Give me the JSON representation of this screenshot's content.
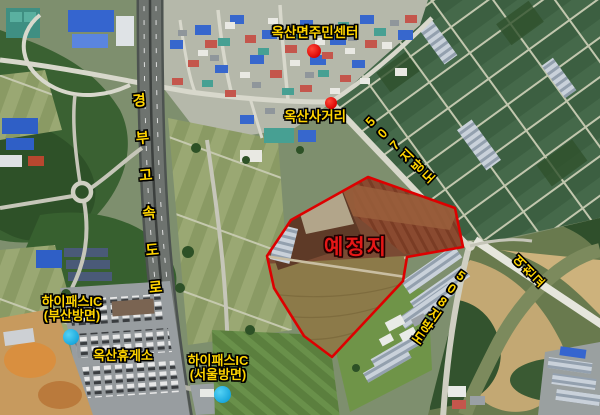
{
  "map": {
    "labels": {
      "community_center": "옥산면주민센터",
      "intersection": "옥산사거리",
      "road_507": "507지방도",
      "expressway": "경부고속도로",
      "hipass_busan": {
        "line1": "하이패스IC",
        "line2": "(부산방면)"
      },
      "rest_area": "옥산휴게소",
      "hipass_seoul": {
        "line1": "하이패스IC",
        "line2": "(서울방면)"
      },
      "road_508": "508지방도",
      "bridge": "여천교",
      "site": "예정지"
    },
    "markers": {
      "community_center": {
        "type": "red-dot"
      },
      "intersection": {
        "type": "red-dot"
      },
      "hipass_busan": {
        "type": "cyan-dot"
      },
      "hipass_seoul": {
        "type": "cyan-dot"
      }
    },
    "colors": {
      "label_yellow": "#ffd400",
      "site_label_red": "#e51717",
      "site_boundary_red": "#dd0000",
      "poi_marker_red": "#e81111",
      "ic_marker_cyan": "#25b2e3"
    }
  }
}
